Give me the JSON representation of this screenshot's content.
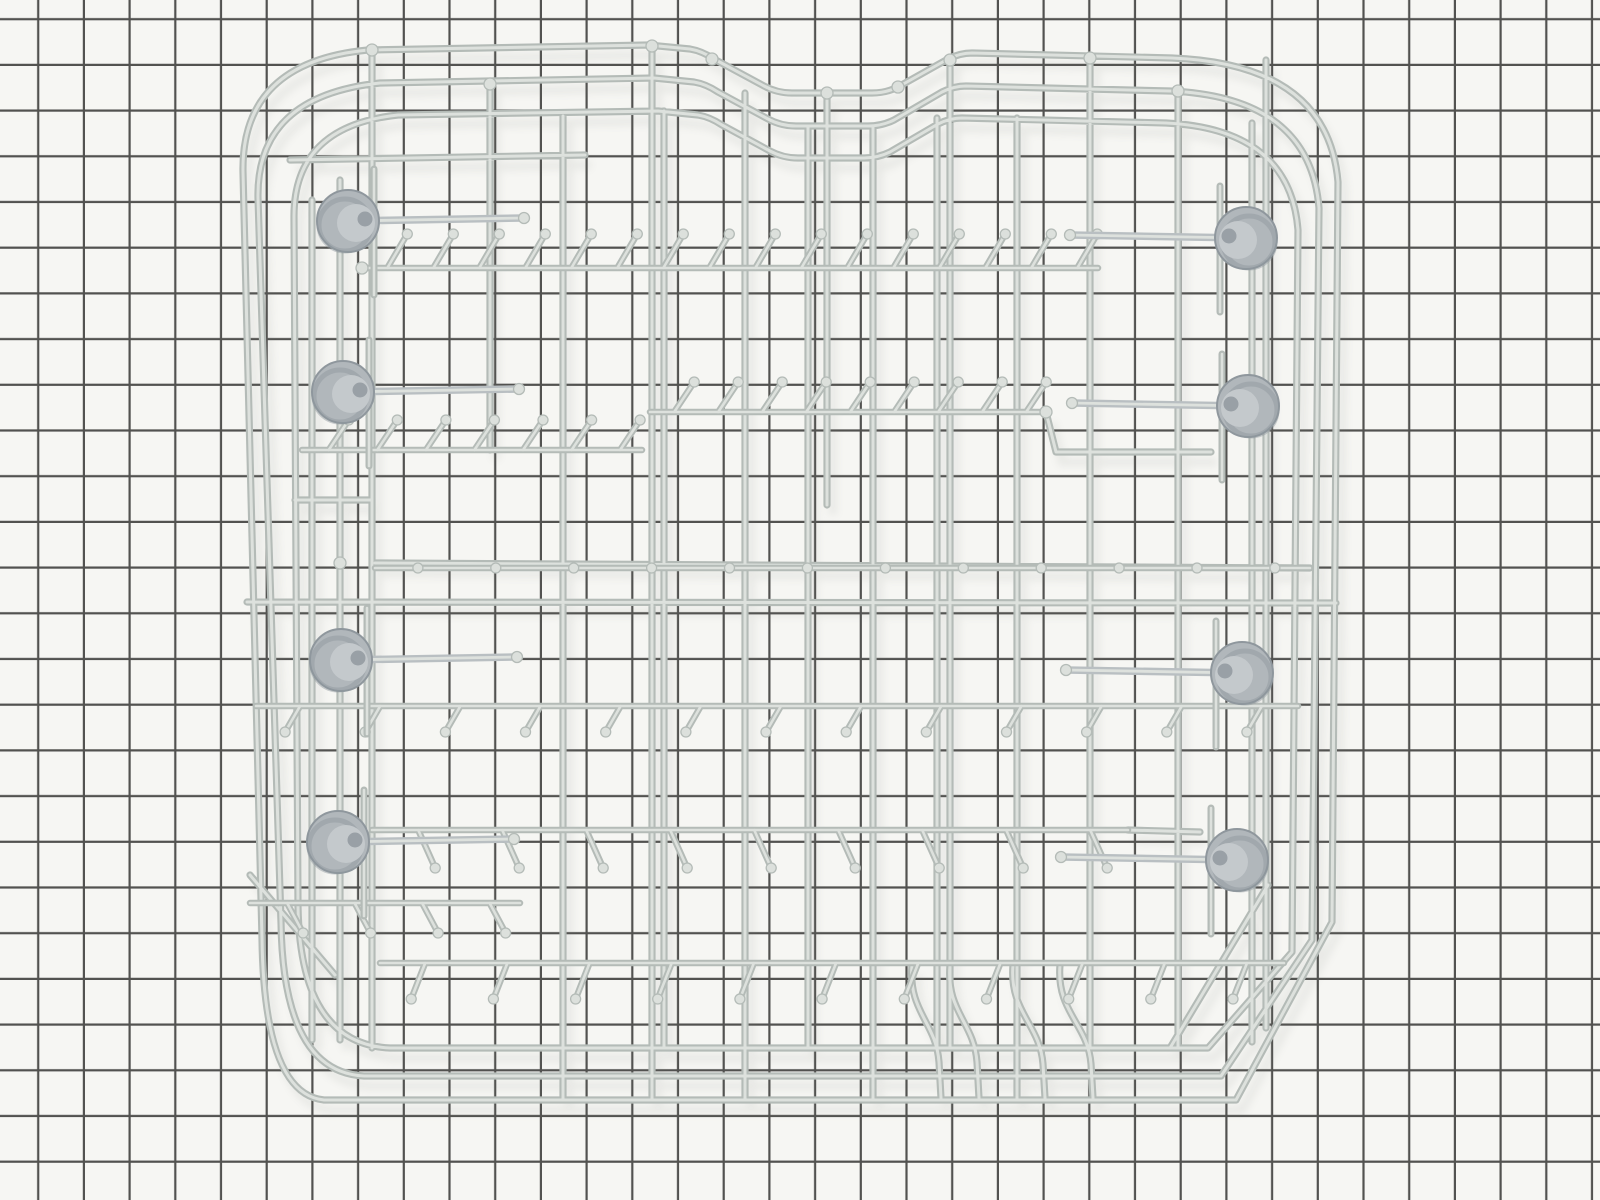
{
  "meta": {
    "subject": "dishwasher lower dish rack product photo",
    "description": "Light gray coated-wire dishwasher rack with eight gray caster wheels, photographed lying on black grid graph paper",
    "visible_text": ""
  },
  "colors": {
    "background": "#f6f6f3",
    "grid_line": "#3b3b39",
    "wire_outline": "#b4bbb7",
    "wire_core": "#dde1dd",
    "ball_fill": "#dce0dc",
    "wheel_body": "#b1b7bb",
    "wheel_shadow": "#8f979d",
    "wheel_face": "#c4c9cc",
    "wheel_hub": "#99a0a6",
    "axle": "#b9bfc2",
    "cast_shadow": "#70756f"
  },
  "scene": {
    "grid": {
      "spacing": 45.7,
      "offset_x": -6.4,
      "offset_y": -25.4,
      "line_width": 2.2
    },
    "wheel_radius": 31,
    "axle_length": 176,
    "wheel_count": 8,
    "wheels": [
      {
        "x": 348,
        "y": 221,
        "side": "left"
      },
      {
        "x": 343,
        "y": 392,
        "side": "left"
      },
      {
        "x": 341,
        "y": 660,
        "side": "left"
      },
      {
        "x": 338,
        "y": 842,
        "side": "left"
      },
      {
        "x": 1246,
        "y": 238,
        "side": "right"
      },
      {
        "x": 1248,
        "y": 406,
        "side": "right"
      },
      {
        "x": 1242,
        "y": 673,
        "side": "right"
      },
      {
        "x": 1237,
        "y": 860,
        "side": "right"
      }
    ],
    "tine_rows": [
      {
        "y": 268,
        "x1": 362,
        "x2": 1098,
        "count": 16,
        "dx": 20,
        "dy": -34
      },
      {
        "y": 450,
        "x1": 302,
        "x2": 642,
        "count": 7,
        "dx": 20,
        "dy": -30
      },
      {
        "y": 412,
        "x1": 650,
        "x2": 1046,
        "count": 9,
        "dx": 20,
        "dy": -30
      },
      {
        "y": 568,
        "x1": 375,
        "x2": 1310,
        "count": 12,
        "dx": 0,
        "dy": 0
      },
      {
        "y": 706,
        "x1": 256,
        "x2": 1298,
        "count": 13,
        "dx": -15,
        "dy": 26
      },
      {
        "y": 830,
        "x1": 372,
        "x2": 1128,
        "count": 9,
        "dx": 17,
        "dy": 38
      },
      {
        "y": 963,
        "x1": 380,
        "x2": 1284,
        "count": 11,
        "dx": -14,
        "dy": 36
      },
      {
        "y": 903,
        "x1": 250,
        "x2": 520,
        "count": 4,
        "dx": 16,
        "dy": 30
      }
    ],
    "joint_balls": [
      [
        652,
        46
      ],
      [
        827,
        93
      ],
      [
        950,
        60
      ],
      [
        372,
        50
      ],
      [
        1090,
        58
      ],
      [
        1178,
        91
      ],
      [
        490,
        84
      ],
      [
        1046,
        412
      ],
      [
        362,
        268
      ],
      [
        340,
        563
      ],
      [
        712,
        59
      ],
      [
        898,
        87
      ]
    ]
  }
}
